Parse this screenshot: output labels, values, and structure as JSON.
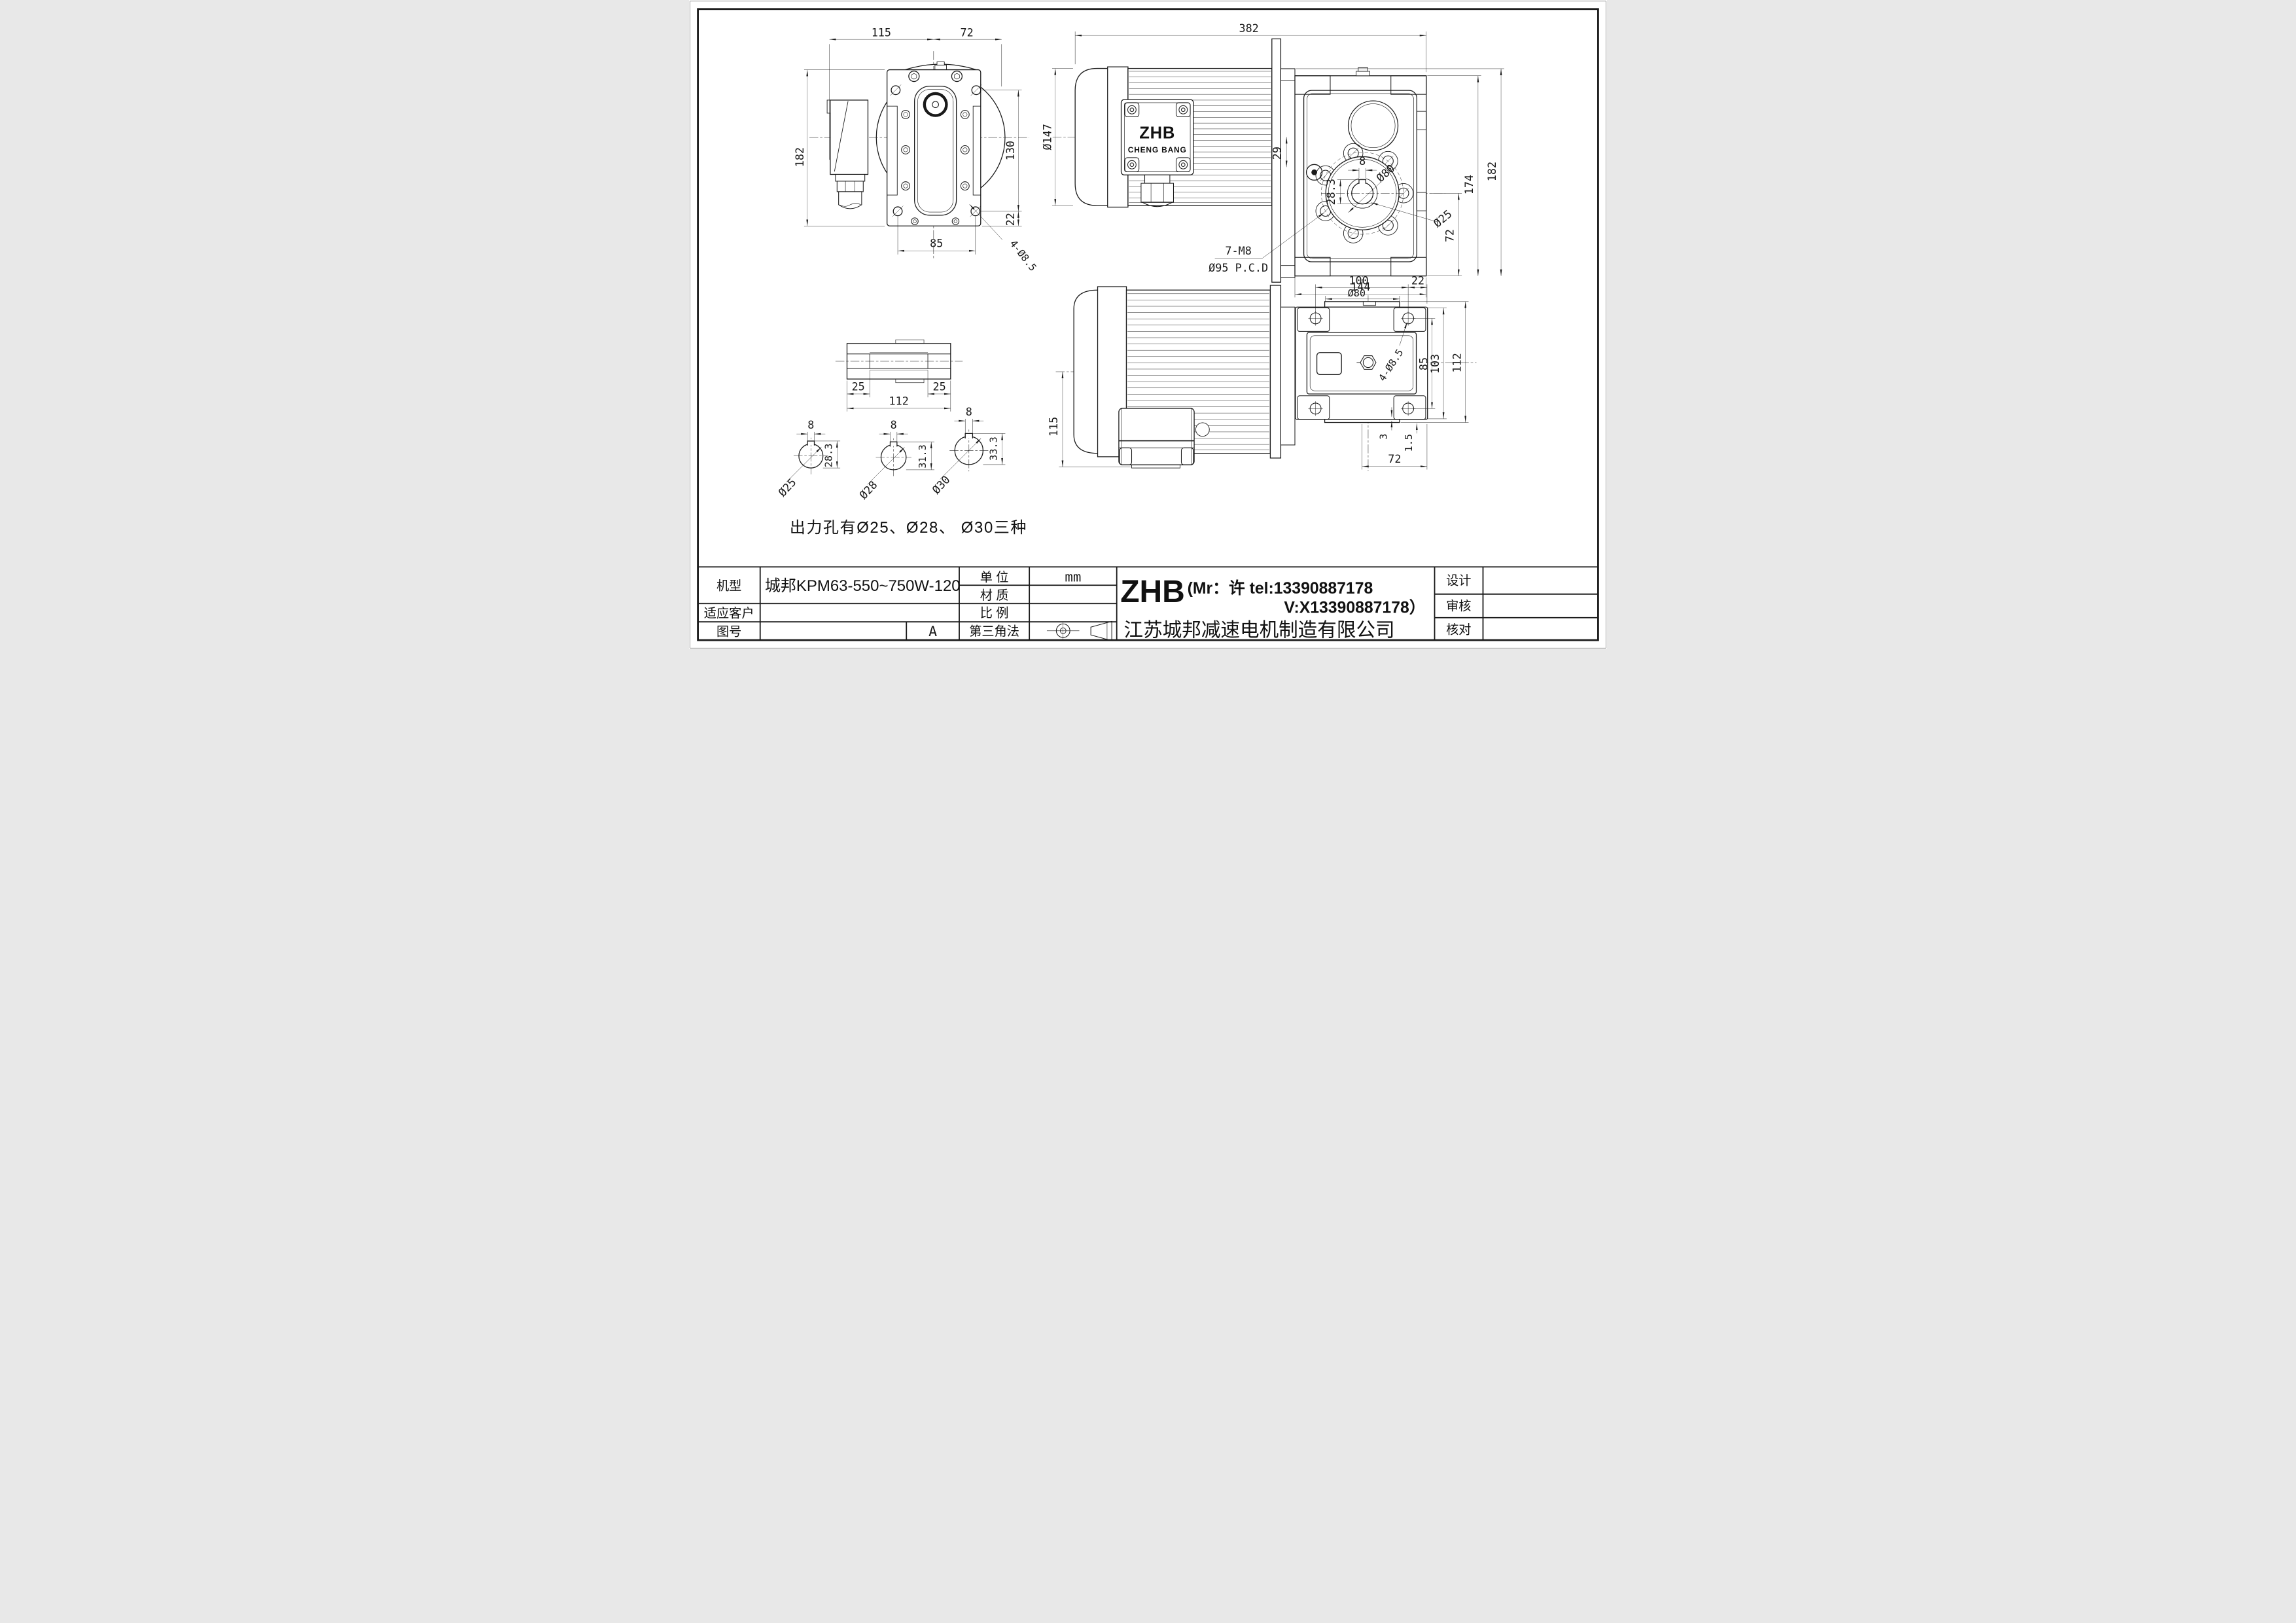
{
  "note": "出力孔有Ø25、Ø28、 Ø30三种",
  "views": {
    "front": {
      "dims": {
        "w115": "115",
        "w72": "72",
        "h182": "182",
        "h130": "130",
        "h22": "22",
        "w85": "85",
        "holes": "4-Ø8.5"
      }
    },
    "side": {
      "dims": {
        "l382": "382",
        "d147": "Ø147",
        "o29": "29",
        "k8": "8",
        "d80": "Ø80",
        "kh": "28.3",
        "d25": "Ø25",
        "o72": "72",
        "h174": "174",
        "h182": "182",
        "w144": "144"
      },
      "flange_note1": "7-M8",
      "flange_note2": "Ø95 P.C.D",
      "box_brand": "ZHB",
      "box_sub": "CHENG BANG"
    },
    "shaft": {
      "dims": {
        "a": "25",
        "b": "112",
        "c": "25"
      }
    },
    "bores": [
      {
        "dia": "Ø25",
        "key": "8",
        "height": "28.3"
      },
      {
        "dia": "Ø28",
        "key": "8",
        "height": "31.3"
      },
      {
        "dia": "Ø30",
        "key": "8",
        "height": "33.3"
      }
    ],
    "plan": {
      "dims": {
        "h115": "115",
        "w100": "100",
        "w22": "22",
        "d80": "Ø80",
        "holes": "4-Ø8.5",
        "h85": "85",
        "h103": "103",
        "h112": "112",
        "s3": "3",
        "s15": "1.5",
        "w72": "72"
      }
    }
  },
  "title_block": {
    "model_label": "机型",
    "model_value": "城邦KPM63-550~750W-120",
    "customer_label": "适应客户",
    "customer_value": "",
    "drawing_no_label": "图号",
    "drawing_no_value": "",
    "revision": "A",
    "unit_label": "单  位",
    "unit_value": "mm",
    "material_label": "材  质",
    "material_value": "",
    "scale_label": "比  例",
    "scale_value": "",
    "projection_label": "第三角法",
    "company_logo": "ZHB",
    "company_contact1": "(Mr：许 tel:13390887178",
    "company_contact2": "V:X13390887178）",
    "company_name": "江苏城邦减速电机制造有限公司",
    "design_label": "设计",
    "review_label": "审核",
    "check_label": "核对"
  }
}
